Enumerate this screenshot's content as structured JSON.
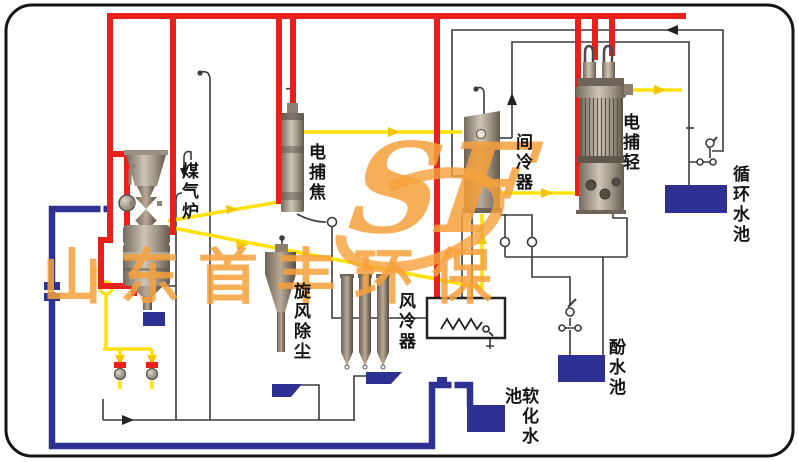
{
  "labels": {
    "gas_furnace": "煤气炉",
    "tar_precipitator": "电捕焦",
    "intercooler": "间冷器",
    "light_oil_precipitator": "电捕轻",
    "circulating_pool": "循环水池",
    "cyclone_dust_collector": "旋风除尘",
    "air_cooler": "风冷器",
    "phenol_pool": "酚水池",
    "softened_water_pool": "软化水池"
  },
  "watermark": {
    "logo_text": "SF",
    "company_text": "山东首丰环保",
    "color": "#f6a13c"
  },
  "colors": {
    "hot_gas_pipe": "#e8211d",
    "tar_liquor_pipe": "#ffe10a",
    "water_pipe": "#2e3192",
    "pool_fill": "#2e3192",
    "thin_line": "#3c3c3c",
    "border": "#151515"
  }
}
